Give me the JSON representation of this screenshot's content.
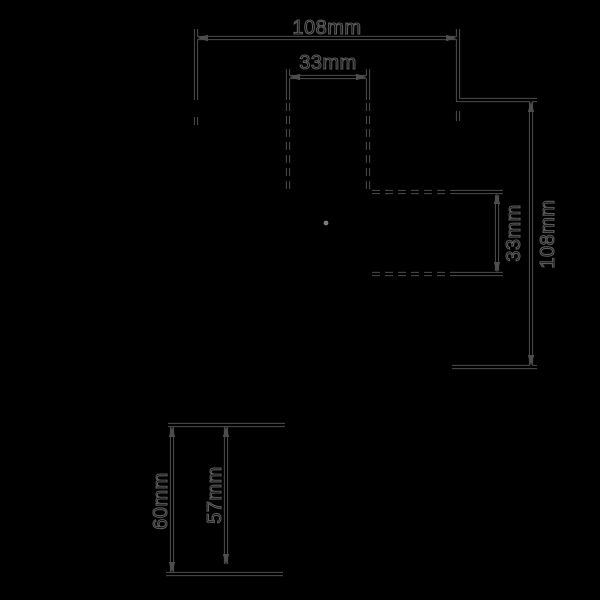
{
  "drawing": {
    "kind": "technical-dimension-drawing",
    "views": [
      "top-plan-view",
      "side-profile-view"
    ],
    "colors": {
      "background": "#000000",
      "line": "#4d4d4d",
      "line_core": "#000000",
      "label_outline": "#5a5a5a",
      "center_mark": "#7d7d7d"
    },
    "labels": {
      "top_width": "108mm",
      "cutout_width": "33mm",
      "cutout_depth": "33mm",
      "side_height": "108mm",
      "profile_height_outer": "60mm",
      "profile_height_inner": "57mm"
    }
  }
}
